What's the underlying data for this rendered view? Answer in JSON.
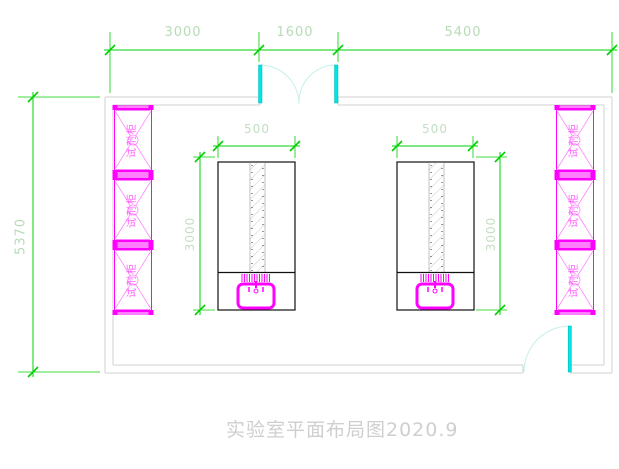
{
  "drawing": {
    "title": "实验室平面布局图2020.9",
    "dimensions": {
      "top_left_width": "3000",
      "top_door_width": "1600",
      "top_right_width": "5400",
      "left_height": "5370",
      "bench_width": "500",
      "bench_length": "3000"
    },
    "cabinet_label": "试剂柜",
    "colors": {
      "dimension_line": "#00d000",
      "dimension_text": "#b7dcb7",
      "wall": "#d2d2d2",
      "door_leaf": "#00e6e6",
      "door_swing": "#c6efec",
      "cad_magenta": "#ff00ff",
      "cabinet_text": "#ff5cff",
      "bench_outline": "#111111",
      "title_text": "#cfcfcf"
    }
  }
}
